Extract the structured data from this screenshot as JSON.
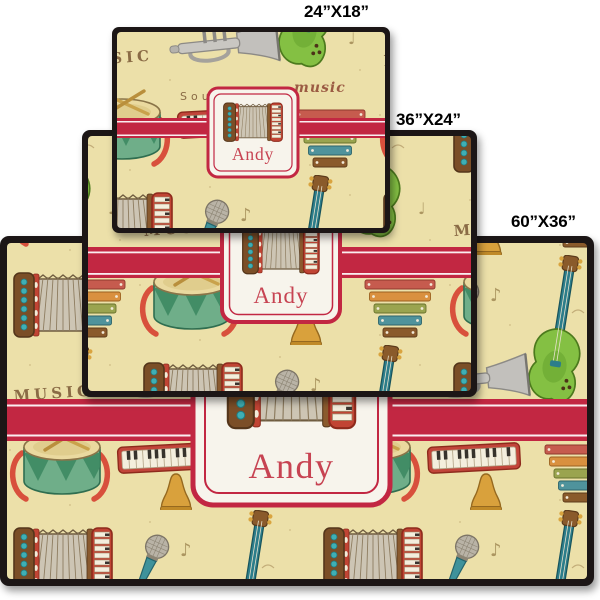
{
  "personalization": {
    "name": "Andy"
  },
  "mats": [
    {
      "id": "mat-60x36",
      "size_label": "60”X36”"
    },
    {
      "id": "mat-36x24",
      "size_label": "36”X24”"
    },
    {
      "id": "mat-24x18",
      "size_label": "24”X18”"
    }
  ],
  "pattern": {
    "words": {
      "caps": "MUSIC",
      "script": "music",
      "sound": "Sound"
    },
    "notes": {
      "eighth": "♪",
      "quarter": "♩"
    },
    "icons": [
      "accordion-icon",
      "drum-icon",
      "electric-guitar-icon",
      "trumpet-icon",
      "bell-icon",
      "microphone-icon",
      "xylophone-icon",
      "piano-keys-icon",
      "music-note-icon"
    ]
  },
  "colors": {
    "page_background": "#ffffff",
    "mat_background": "#ece0a9",
    "mat_border": "#1a1716",
    "band_red": "#c22742",
    "label_background": "#f7f4ec",
    "label_border_red": "#c22742",
    "name_text": "#c74352",
    "size_label_text": "#000000",
    "pattern_word_brown": "#8a6b45"
  }
}
